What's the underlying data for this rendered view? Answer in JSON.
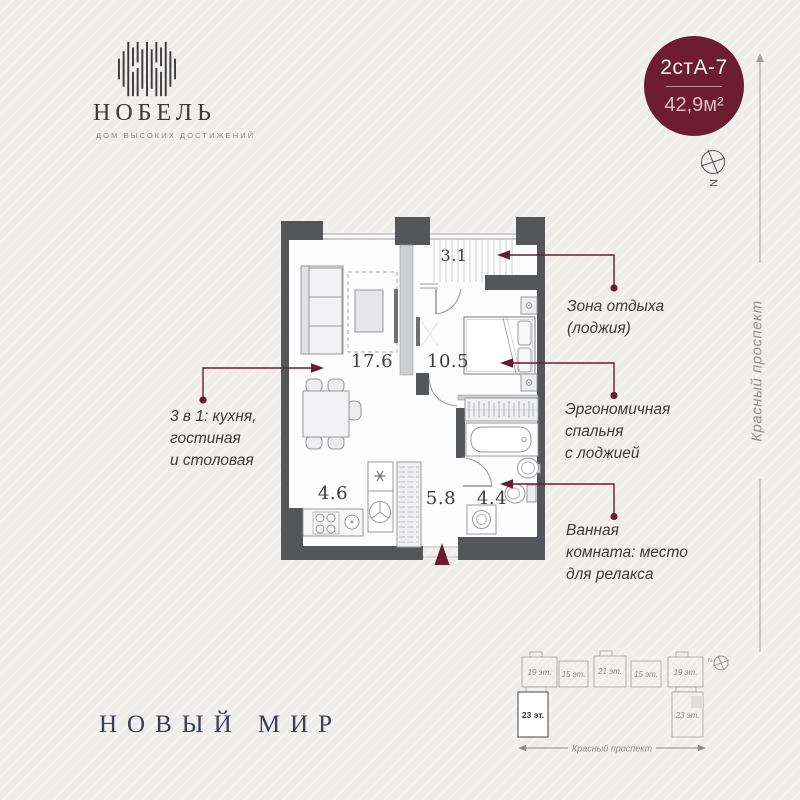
{
  "brand": {
    "logo_name": "НОБЕЛЬ",
    "logo_tagline": "дом высоких достижений",
    "footer_name": "НОВЫЙ МИР"
  },
  "unit_badge": {
    "code": "2стА-7",
    "area": "42,9м²"
  },
  "compass": {
    "direction_letter": "N"
  },
  "street": {
    "name": "Красный проспект"
  },
  "floor_plan": {
    "rooms": {
      "living": "17.6",
      "bedroom": "10.5",
      "loggia": "3.1",
      "kitchen": "4.6",
      "hallway": "5.8",
      "bathroom": "4.4"
    }
  },
  "annotations": {
    "kitchen": "3 в 1: кухня,\nгостиная\nи столовая",
    "loggia": "Зона отдыха\n(лоджия)",
    "bedroom": "Эргономичная\nспальня\nс лоджией",
    "bathroom": "Ванная\nкомната: место\nдля релакса"
  },
  "site_plan": {
    "blocks": [
      "19 эт.",
      "15 эт.",
      "21 эт.",
      "15 эт.",
      "19 эт."
    ],
    "tower_left": "23 эт.",
    "tower_right": "23 эт.",
    "street_label": "Красный проспект",
    "compass_letter": "N"
  },
  "colors": {
    "accent_maroon": "#6d1c31",
    "wall_dark": "#54565a"
  }
}
